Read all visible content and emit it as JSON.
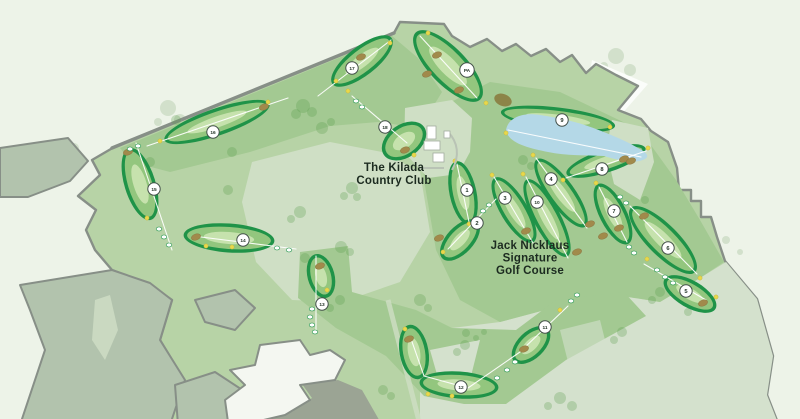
{
  "map": {
    "labels": {
      "clubhouse": {
        "lines": [
          "The Kilada",
          "Country Club"
        ],
        "x": 394,
        "y": 171,
        "line_height": 13
      },
      "course": {
        "lines": [
          "Jack Nicklaus",
          "Signature",
          "Golf Course"
        ],
        "x": 530,
        "y": 249,
        "line_height": 12.5
      }
    },
    "holes": [
      {
        "n": "1",
        "m": [
          467,
          190
        ],
        "b": [
          [
            463,
            193,
            29,
            10,
            78
          ]
        ],
        "l": [
          [
            457,
            164
          ],
          [
            469,
            222
          ]
        ],
        "k": [],
        "d": [
          [
            455,
            161
          ],
          [
            469,
            224
          ]
        ],
        "t": []
      },
      {
        "n": "2",
        "m": [
          477,
          223
        ],
        "b": [
          [
            460,
            240,
            22,
            10,
            133
          ]
        ],
        "l": [
          [
            496,
            199
          ],
          [
            448,
            249
          ]
        ],
        "k": [
          [
            439,
            238
          ]
        ],
        "d": [
          [
            443,
            252
          ]
        ],
        "t": [
          [
            489,
            205
          ],
          [
            483,
            211
          ]
        ]
      },
      {
        "n": "3",
        "m": [
          505,
          198
        ],
        "b": [
          [
            514,
            210,
            34,
            10,
            59
          ]
        ],
        "l": [
          [
            494,
            177
          ],
          [
            533,
            243
          ]
        ],
        "k": [
          [
            526,
            231
          ]
        ],
        "d": [
          [
            492,
            175
          ]
        ],
        "t": []
      },
      {
        "n": "10",
        "m": [
          537,
          202
        ],
        "b": [
          [
            547,
            218,
            40,
            10,
            62
          ]
        ],
        "l": [
          [
            526,
            177
          ],
          [
            568,
            258
          ]
        ],
        "k": [
          [
            577,
            252
          ]
        ],
        "d": [
          [
            523,
            174
          ]
        ],
        "t": []
      },
      {
        "n": "4",
        "m": [
          551,
          179
        ],
        "b": [
          [
            561,
            193,
            38,
            10,
            54
          ]
        ],
        "l": [
          [
            536,
            158
          ],
          [
            587,
            228
          ]
        ],
        "k": [
          [
            590,
            224
          ],
          [
            603,
            236
          ]
        ],
        "d": [
          [
            533,
            155
          ]
        ],
        "t": []
      },
      {
        "n": "5",
        "m": [
          686,
          291
        ],
        "b": [
          [
            690,
            294,
            26,
            10,
            30
          ]
        ],
        "l": [
          [
            644,
            264
          ],
          [
            706,
            300
          ]
        ],
        "k": [
          [
            703,
            303
          ]
        ],
        "d": [
          [
            647,
            259
          ],
          [
            716,
            297
          ]
        ],
        "t": [
          [
            657,
            270
          ],
          [
            665,
            277
          ],
          [
            673,
            283
          ]
        ]
      },
      {
        "n": "6",
        "m": [
          668,
          248
        ],
        "b": [
          [
            663,
            240,
            42,
            12,
            45
          ]
        ],
        "l": [
          [
            630,
            206
          ],
          [
            697,
            274
          ]
        ],
        "k": [
          [
            644,
            216
          ]
        ],
        "d": [
          [
            700,
            278
          ]
        ],
        "t": [
          [
            620,
            197
          ],
          [
            626,
            203
          ]
        ]
      },
      {
        "n": "7",
        "m": [
          614,
          211
        ],
        "b": [
          [
            613,
            214,
            30,
            10,
            63
          ]
        ],
        "l": [
          [
            599,
            187
          ],
          [
            627,
            242
          ]
        ],
        "k": [
          [
            619,
            228
          ]
        ],
        "d": [
          [
            596,
            183
          ]
        ],
        "t": [
          [
            629,
            247
          ],
          [
            634,
            253
          ]
        ]
      },
      {
        "n": "8",
        "m": [
          602,
          169
        ],
        "b": [
          [
            606,
            161,
            38,
            8,
            -18
          ]
        ],
        "l": [
          [
            566,
            178
          ],
          [
            646,
            151
          ]
        ],
        "k": [
          [
            624,
            159
          ]
        ],
        "d": [
          [
            563,
            180
          ],
          [
            648,
            148
          ]
        ],
        "t": []
      },
      {
        "n": "9",
        "m": [
          562,
          120
        ],
        "b": [
          [
            558,
            119,
            54,
            8,
            7
          ]
        ],
        "l": [
          [
            508,
            130
          ],
          [
            641,
            157
          ]
        ],
        "k": [
          [
            631,
            161
          ]
        ],
        "d": [
          [
            506,
            133
          ],
          [
            610,
            127
          ]
        ],
        "t": []
      },
      {
        "n": "11",
        "m": [
          545,
          327
        ],
        "b": [
          [
            531,
            345,
            20,
            10,
            136
          ]
        ],
        "l": [
          [
            568,
            306
          ],
          [
            522,
            350
          ]
        ],
        "k": [
          [
            524,
            349
          ]
        ],
        "d": [
          [
            560,
            310
          ]
        ],
        "t": [
          [
            571,
            301
          ],
          [
            577,
            295
          ]
        ]
      },
      {
        "n": "12",
        "m": [
          461,
          387
        ],
        "b": [
          [
            414,
            352,
            24,
            11,
            80
          ],
          [
            459,
            385,
            36,
            10,
            4
          ]
        ],
        "l": [
          [
            410,
            336
          ],
          [
            424,
            376
          ],
          [
            468,
            388
          ],
          [
            520,
            352
          ]
        ],
        "k": [
          [
            409,
            339
          ]
        ],
        "d": [
          [
            405,
            329
          ],
          [
            428,
            394
          ],
          [
            452,
            396
          ]
        ],
        "t": [
          [
            497,
            378
          ],
          [
            507,
            370
          ],
          [
            515,
            362
          ]
        ]
      },
      {
        "n": "13",
        "m": [
          322,
          304
        ],
        "b": [
          [
            321,
            276,
            19,
            10,
            75
          ]
        ],
        "l": [
          [
            316,
            256
          ],
          [
            316,
            330
          ]
        ],
        "k": [
          [
            320,
            266
          ]
        ],
        "d": [
          [
            327,
            290
          ]
        ],
        "t": [
          [
            312,
            309
          ],
          [
            310,
            317
          ],
          [
            312,
            325
          ],
          [
            315,
            332
          ]
        ]
      },
      {
        "n": "14",
        "m": [
          243,
          240
        ],
        "b": [
          [
            229,
            238,
            42,
            11,
            4
          ]
        ],
        "l": [
          [
            193,
            236
          ],
          [
            296,
            249
          ]
        ],
        "k": [
          [
            196,
            237
          ]
        ],
        "d": [
          [
            206,
            246
          ],
          [
            232,
            247
          ]
        ],
        "t": [
          [
            277,
            248
          ],
          [
            289,
            250
          ]
        ]
      },
      {
        "n": "15",
        "m": [
          154,
          189
        ],
        "b": [
          [
            140,
            184,
            34,
            12,
            73
          ]
        ],
        "l": [
          [
            136,
            143
          ],
          [
            172,
            250
          ]
        ],
        "k": [
          [
            128,
            152
          ]
        ],
        "d": [
          [
            147,
            218
          ]
        ],
        "t": [
          [
            159,
            229
          ],
          [
            164,
            237
          ],
          [
            169,
            245
          ]
        ]
      },
      {
        "n": "16",
        "m": [
          213,
          132
        ],
        "b": [
          [
            217,
            122,
            52,
            10,
            -19
          ]
        ],
        "l": [
          [
            147,
            146
          ],
          [
            288,
            98
          ]
        ],
        "k": [
          [
            264,
            107
          ]
        ],
        "d": [
          [
            160,
            141
          ],
          [
            268,
            102
          ]
        ],
        "t": [
          [
            138,
            146
          ],
          [
            130,
            149
          ]
        ]
      },
      {
        "n": "17",
        "m": [
          352,
          68
        ],
        "b": [
          [
            362,
            61,
            34,
            11,
            -38
          ]
        ],
        "l": [
          [
            318,
            96
          ],
          [
            391,
            40
          ]
        ],
        "k": [
          [
            361,
            57
          ]
        ],
        "d": [
          [
            336,
            81
          ],
          [
            390,
            43
          ]
        ],
        "t": []
      },
      {
        "n": "18",
        "m": [
          385,
          127
        ],
        "b": [
          [
            404,
            141,
            21,
            13,
            -35
          ]
        ],
        "l": [
          [
            352,
            96
          ],
          [
            407,
            143
          ]
        ],
        "k": [
          [
            405,
            150
          ]
        ],
        "d": [
          [
            348,
            91
          ],
          [
            414,
            155
          ]
        ],
        "t": [
          [
            356,
            101
          ],
          [
            362,
            107
          ]
        ]
      },
      {
        "n": "PA",
        "m": [
          467,
          70
        ],
        "b": [
          [
            448,
            66,
            43,
            15,
            46
          ]
        ],
        "l": [
          [
            420,
            36
          ],
          [
            477,
            98
          ]
        ],
        "k": [
          [
            437,
            55
          ],
          [
            427,
            74
          ],
          [
            459,
            90
          ]
        ],
        "d": [
          [
            428,
            33
          ],
          [
            486,
            103
          ]
        ],
        "t": []
      }
    ],
    "colors": {
      "background": "#edf3e8",
      "property_base": "#b7d3a6",
      "property_dark": "#a3c992",
      "property_pale": "#cfdfc5",
      "property_pale2": "#d4e1cd",
      "parcel": "#b2c3ad",
      "border_gray": "#878f87",
      "lake": "#b4d8e7",
      "hole_rim": "#1f9348",
      "fairway": "#93c67e",
      "fairway_light": "#c6e2ad",
      "bunker": "#a18a4b",
      "bunker_dark": "#8c8448",
      "tee_dot": "#e8d84b",
      "quarry": "#f4f7f1",
      "quarry_shadow": "#9ba494",
      "white_patch": "#fbfdfa",
      "building": "#ffffff",
      "path_gray": "#b9c3b5",
      "sight_line": "#ffffff",
      "label_text": "#1c2b20",
      "marker_stroke": "#44514a",
      "marker_text": "#243528",
      "tree_in": "#579a49",
      "tree_out": "#c8d9c2"
    }
  }
}
